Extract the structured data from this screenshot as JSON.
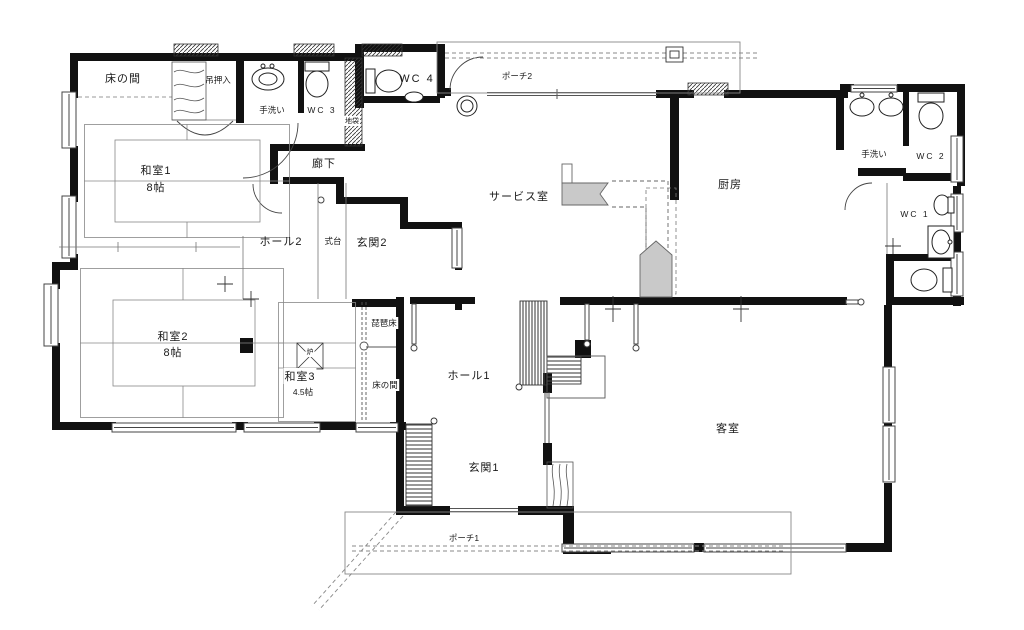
{
  "labels": {
    "tokonoma_nw": "床の間",
    "tsurioshiire": "吊押入",
    "tearai_nw": "手洗い",
    "wc3": "WC 3",
    "jibukuro": "地袋",
    "wc4": "WC 4",
    "porch2": "ポーチ2",
    "rouka": "廊下",
    "washitsu1": "和室1",
    "washitsu1_size": "8帖",
    "hall2": "ホール2",
    "shikidai": "式台",
    "genkan2": "玄関2",
    "service": "サービス室",
    "kitchen": "厨房",
    "tearai_ne": "手洗い",
    "wc2": "WC 2",
    "wc1": "WC 1",
    "washitsu2": "和室2",
    "washitsu2_size": "8帖",
    "ro": "炉",
    "washitsu3": "和室3",
    "washitsu3_size": "4.5帖",
    "biwadoko": "琵琶床",
    "tokonoma_c": "床の間",
    "hall1": "ホール1",
    "genkan1": "玄関1",
    "kyakushitsu": "客室",
    "porch1": "ポーチ1"
  },
  "colors": {
    "wall": "#111111",
    "thin_line": "#555555",
    "tatami_line": "#888888",
    "gray_fill": "#c9c9c9",
    "background": "#ffffff"
  }
}
